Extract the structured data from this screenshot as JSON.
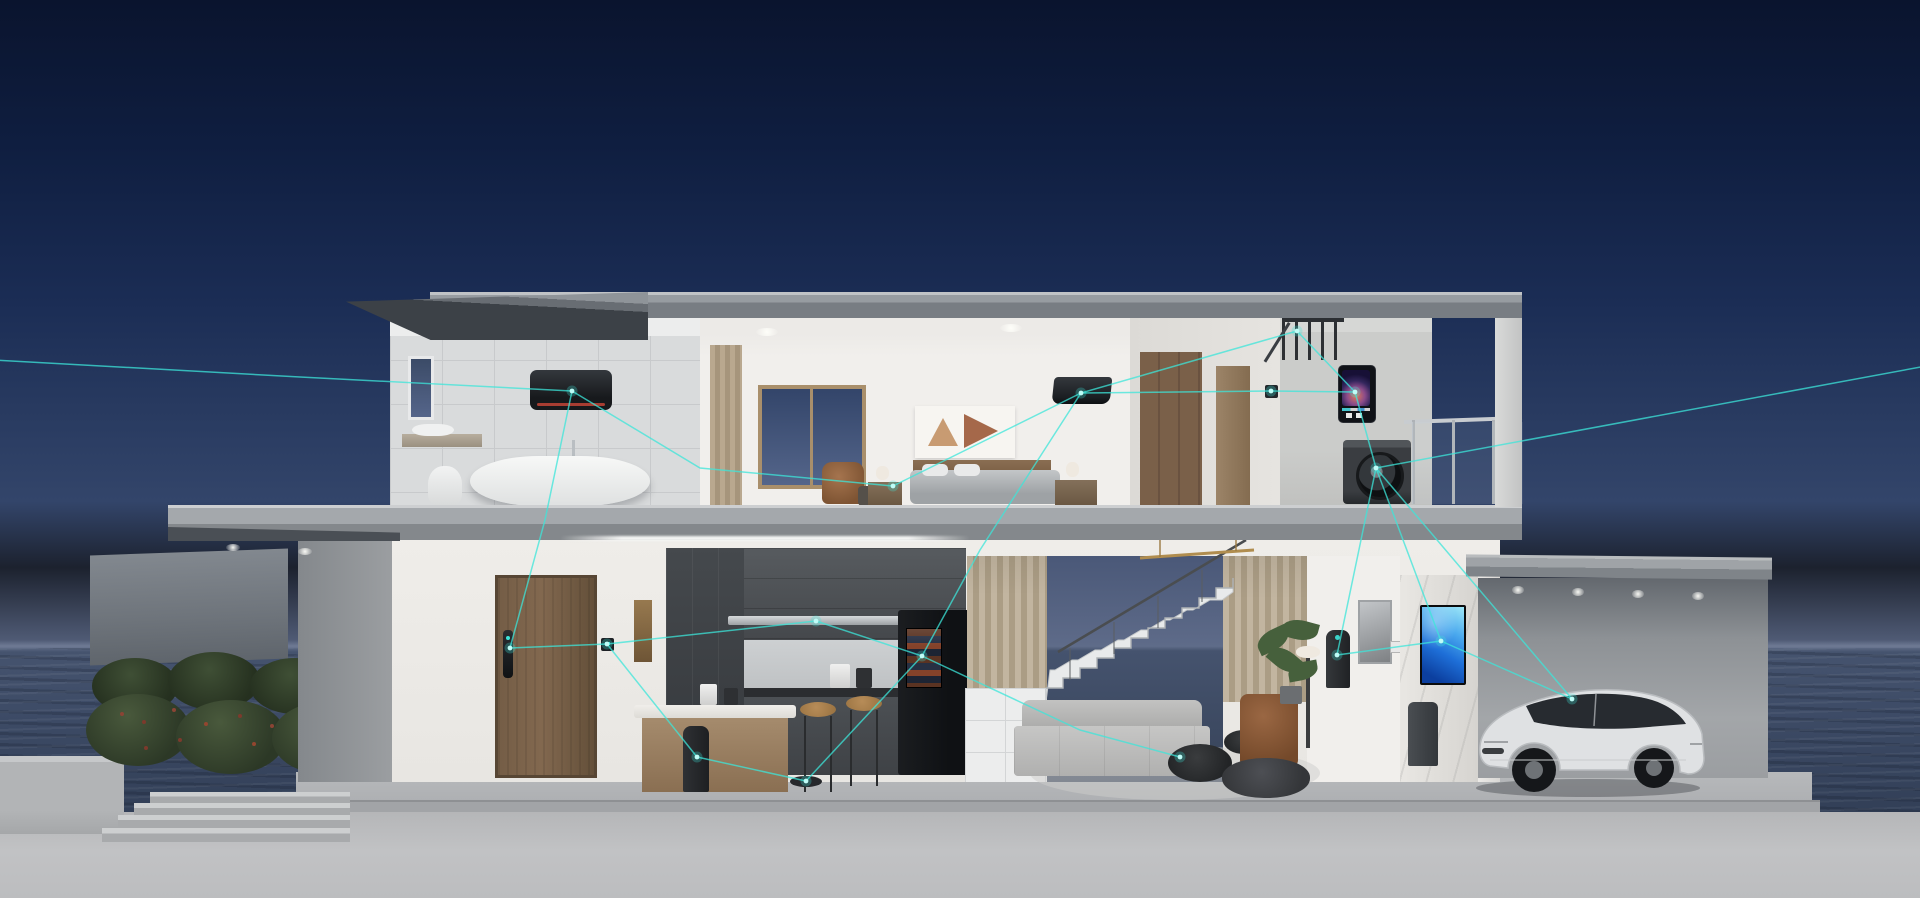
{
  "scene": {
    "description": "Cutaway 3D render of a modern two-story smart home at dusk by the sea; glowing teal network lines link every smart appliance",
    "time_of_day": "dusk",
    "setting": "seaside"
  },
  "colors": {
    "sky_top": "#0a142e",
    "sky_mid": "#1b2d55",
    "sky_low": "#33456a",
    "sky_horizon": "#5d6a88",
    "ocean": "#46546f",
    "ocean_deep": "#323f57",
    "roof_top": "#979ca1",
    "roof_face": "#787d83",
    "roof_under": "#3c4147",
    "slab": "#a4a8ac",
    "wall_white": "#f1efec",
    "tile": "#d9dbdc",
    "cabinet_dark": "#45484c",
    "door_wood": "#82684f",
    "curtain": "#c2b5a0",
    "marble": "#e9e7e3",
    "accent": "#3ce5da",
    "tv_blue": "#1e6fd8",
    "car_body": "#dfe1e3",
    "hedge": "#33402b",
    "ground": "#c1c2c4"
  },
  "rooms": [
    {
      "id": "bathroom",
      "floor": "upper",
      "objects": [
        "wall-water-heater",
        "bathtub",
        "tub-faucet",
        "washbasin",
        "toilet",
        "window"
      ]
    },
    {
      "id": "bedroom",
      "floor": "upper",
      "objects": [
        "air-conditioner",
        "bed",
        "headboard",
        "bedside-lamps",
        "wall-art",
        "window",
        "curtain",
        "armchair"
      ]
    },
    {
      "id": "hallway",
      "floor": "upper",
      "objects": [
        "wardrobe",
        "door",
        "thermostat"
      ]
    },
    {
      "id": "laundry-balcony",
      "floor": "upper",
      "objects": [
        "ceiling-drying-rack",
        "gas-water-heater",
        "washing-machine",
        "glass-railing"
      ]
    },
    {
      "id": "entry",
      "floor": "ground",
      "objects": [
        "front-door",
        "smart-door-lock",
        "wall-control-panel",
        "wall-art-strip"
      ]
    },
    {
      "id": "kitchen",
      "floor": "ground",
      "objects": [
        "range-hood",
        "upper-cabinets",
        "smart-fridge",
        "kitchen-island",
        "bar-stools",
        "smart-speaker",
        "robot-vacuum",
        "small-appliances"
      ]
    },
    {
      "id": "living-room",
      "floor": "ground",
      "objects": [
        "slat-curtains",
        "staircase",
        "understair-shelf",
        "sofa",
        "coffee-tables",
        "leather-armchair",
        "floor-lamp",
        "bean-bag",
        "potted-plant",
        "air-purifier",
        "art-frame",
        "light-switch",
        "wall-tv",
        "trash-bin"
      ]
    },
    {
      "id": "garage",
      "floor": "ground",
      "objects": [
        "suv-car",
        "downlights"
      ]
    },
    {
      "id": "yard",
      "floor": "outside",
      "objects": [
        "privacy-wall",
        "hedges",
        "berry-shrubs",
        "steps",
        "planter-wall"
      ]
    }
  ],
  "network": {
    "accent": "#3ce5da",
    "node_fill": "#bffcf7",
    "stroke_width": 1.5,
    "nodes": [
      {
        "id": "exit-left",
        "x": -6,
        "y": 360
      },
      {
        "id": "bath-heater",
        "x": 572,
        "y": 391
      },
      {
        "id": "door-lock",
        "x": 510,
        "y": 648
      },
      {
        "id": "entry-panel",
        "x": 607,
        "y": 644
      },
      {
        "id": "hood",
        "x": 816,
        "y": 621
      },
      {
        "id": "fridge",
        "x": 922,
        "y": 656
      },
      {
        "id": "speaker",
        "x": 697,
        "y": 757
      },
      {
        "id": "vacuum",
        "x": 806,
        "y": 781
      },
      {
        "id": "bed-lamp",
        "x": 893,
        "y": 486
      },
      {
        "id": "bedroom-ac",
        "x": 1081,
        "y": 393
      },
      {
        "id": "hall-thermostat",
        "x": 1271,
        "y": 391
      },
      {
        "id": "drying-rack",
        "x": 1297,
        "y": 331
      },
      {
        "id": "gas-heater",
        "x": 1355,
        "y": 392
      },
      {
        "id": "washer",
        "x": 1376,
        "y": 468
      },
      {
        "id": "tv",
        "x": 1441,
        "y": 641
      },
      {
        "id": "purifier",
        "x": 1337,
        "y": 655
      },
      {
        "id": "living-table",
        "x": 1180,
        "y": 757
      },
      {
        "id": "car",
        "x": 1572,
        "y": 699
      },
      {
        "id": "exit-right",
        "x": 1926,
        "y": 366
      }
    ],
    "edges": [
      {
        "from": "exit-left",
        "to": "bath-heater",
        "via": [
          [
            300,
            377
          ]
        ]
      },
      {
        "from": "bath-heater",
        "to": "bed-lamp",
        "via": [
          [
            700,
            468
          ]
        ]
      },
      {
        "from": "bed-lamp",
        "to": "bedroom-ac"
      },
      {
        "from": "bath-heater",
        "to": "door-lock",
        "via": [
          [
            545,
            520
          ]
        ]
      },
      {
        "from": "door-lock",
        "to": "entry-panel"
      },
      {
        "from": "entry-panel",
        "to": "speaker"
      },
      {
        "from": "speaker",
        "to": "vacuum"
      },
      {
        "from": "vacuum",
        "to": "fridge"
      },
      {
        "from": "entry-panel",
        "to": "hood"
      },
      {
        "from": "hood",
        "to": "fridge"
      },
      {
        "from": "bedroom-ac",
        "to": "fridge",
        "via": [
          [
            980,
            550
          ]
        ]
      },
      {
        "from": "bedroom-ac",
        "to": "drying-rack"
      },
      {
        "from": "bedroom-ac",
        "to": "hall-thermostat"
      },
      {
        "from": "hall-thermostat",
        "to": "gas-heater"
      },
      {
        "from": "drying-rack",
        "to": "gas-heater"
      },
      {
        "from": "gas-heater",
        "to": "washer"
      },
      {
        "from": "washer",
        "to": "exit-right"
      },
      {
        "from": "washer",
        "to": "tv"
      },
      {
        "from": "washer",
        "to": "car"
      },
      {
        "from": "washer",
        "to": "purifier"
      },
      {
        "from": "tv",
        "to": "car"
      },
      {
        "from": "tv",
        "to": "purifier"
      },
      {
        "from": "fridge",
        "to": "living-table",
        "via": [
          [
            1080,
            730
          ]
        ]
      }
    ]
  }
}
